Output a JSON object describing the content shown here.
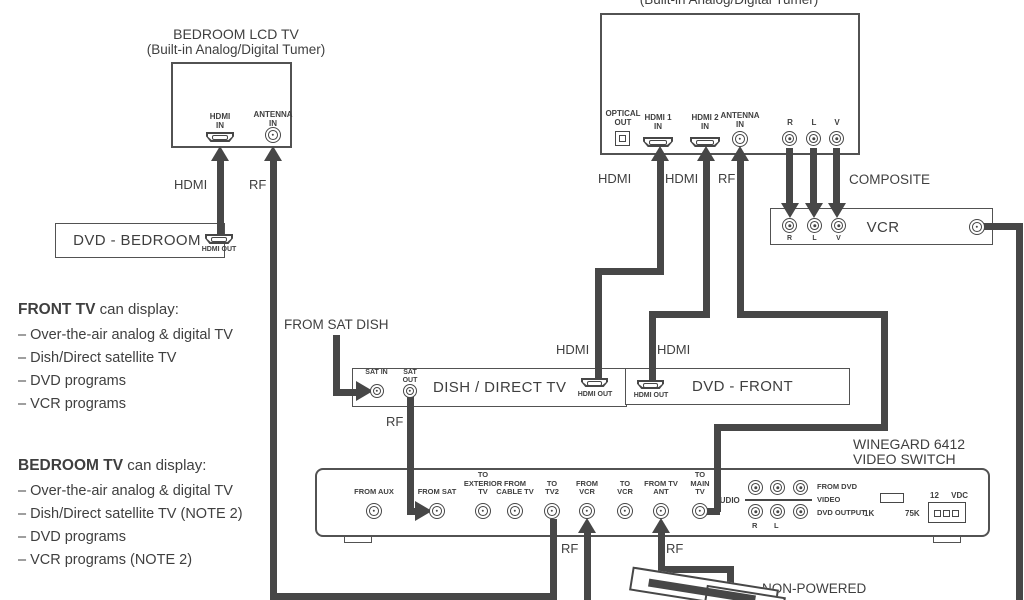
{
  "colors": {
    "ink": "#474747",
    "text": "#3f3f3f",
    "background": "#ffffff"
  },
  "bedroom_tv": {
    "title": "BEDROOM LCD TV",
    "subtitle": "(Built-in Analog/Digital Tumer)",
    "hdmi_in": "HDMI IN",
    "antenna_in": "ANTENNA IN"
  },
  "front_tv": {
    "subtitle": "(Built-in Analog/Digital Tumer)",
    "optical_out": "OPTICAL OUT",
    "hdmi1_in": "HDMI 1 IN",
    "hdmi2_in": "HDMI 2 IN",
    "antenna_in": "ANTENNA IN",
    "jack_r": "R",
    "jack_l": "L",
    "jack_v": "V"
  },
  "dvd_bedroom": {
    "title": "DVD - BEDROOM",
    "hdmi_out": "HDMI OUT"
  },
  "vcr": {
    "title": "VCR",
    "jack_r": "R",
    "jack_l": "L",
    "jack_v": "V"
  },
  "dish": {
    "title": "DISH / DIRECT TV",
    "sat_in": "SAT IN",
    "sat_out": "SAT OUT",
    "hdmi_out": "HDMI OUT"
  },
  "dvd_front": {
    "title": "DVD - FRONT",
    "hdmi_out": "HDMI OUT"
  },
  "video_switch": {
    "title_line1": "WINEGARD 6412",
    "title_line2": "VIDEO SWITCH",
    "jacks": [
      "FROM AUX",
      "FROM SAT",
      "TO EXTERIOR TV",
      "FROM CABLE TV",
      "TO TV2",
      "FROM VCR",
      "TO VCR",
      "FROM TV ANT",
      "TO MAIN TV"
    ],
    "audio": "AUDIO",
    "from_dvd": "FROM DVD",
    "video": "VIDEO",
    "dvd_output": "DVD OUTPUT",
    "jack_r": "R",
    "jack_l": "L",
    "res_1k": "1K",
    "res_75k": "75K",
    "power": "12 VDC"
  },
  "notes_front": {
    "heading_bold": "FRONT TV",
    "heading_rest": " can display:",
    "items": [
      "– Over-the-air analog & digital TV",
      "– Dish/Direct satellite TV",
      "– DVD programs",
      "– VCR programs"
    ]
  },
  "notes_bedroom": {
    "heading_bold": "BEDROOM TV",
    "heading_rest": " can display:",
    "items": [
      "– Over-the-air analog & digital TV",
      "– Dish/Direct satellite TV (NOTE 2)",
      "– DVD programs",
      "– VCR programs (NOTE 2)"
    ]
  },
  "labels": {
    "hdmi_bedroom": "HDMI",
    "rf_bedroom": "RF",
    "hdmi_sat_top": "HDMI",
    "hdmi_dvd_top": "HDMI",
    "rf_ant_top": "RF",
    "composite": "COMPOSITE",
    "from_sat_dish": "FROM SAT DISH",
    "hdmi_dish_out": "HDMI",
    "hdmi_dvd_front_out": "HDMI",
    "rf_sat_out": "RF",
    "rf_to_tv2": "RF",
    "rf_tv_ant": "RF",
    "non_powered": "NON-POWERED"
  }
}
